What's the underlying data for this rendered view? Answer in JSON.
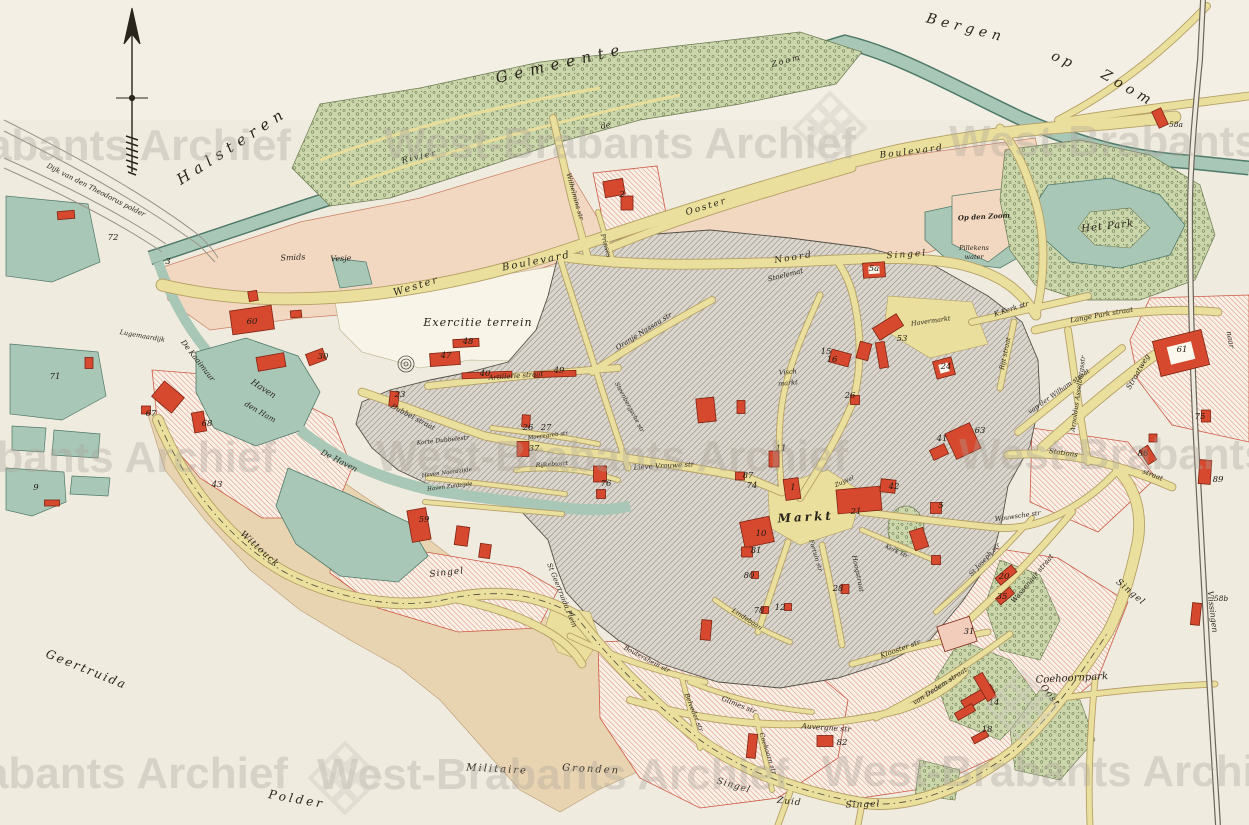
{
  "_format": "labels: t=text x,y=position r=rotation(deg) s=font-size ls=letter-spacing w=bold; numbers: building/parcel numbers printed on map; buildings: red building footprints x,y=center w,h=size r=rotation light=outlined-pale",
  "map_region": "Bergen op Zoom town plan",
  "labels": [
    {
      "t": "Gemeente",
      "x": 562,
      "y": 68,
      "r": -13,
      "s": 15,
      "ls": 7
    },
    {
      "t": "Halsteren",
      "x": 235,
      "y": 150,
      "r": -33,
      "s": 15,
      "ls": 6
    },
    {
      "t": "Bergen",
      "x": 965,
      "y": 32,
      "r": 14,
      "s": 14,
      "ls": 5
    },
    {
      "t": "op",
      "x": 1062,
      "y": 64,
      "r": 24,
      "s": 14,
      "ls": 4
    },
    {
      "t": "Zoom",
      "x": 1126,
      "y": 92,
      "r": 30,
      "s": 14,
      "ls": 5
    },
    {
      "t": "Geertruida",
      "x": 85,
      "y": 673,
      "r": 22,
      "s": 12,
      "ls": 2
    },
    {
      "t": "Polder",
      "x": 296,
      "y": 803,
      "r": 10,
      "s": 12,
      "ls": 3
    },
    {
      "t": "Militaire",
      "x": 497,
      "y": 772,
      "r": 3,
      "s": 10,
      "ls": 2
    },
    {
      "t": "Gronden",
      "x": 591,
      "y": 772,
      "r": 3,
      "s": 10,
      "ls": 2
    },
    {
      "t": "Exercitie terrein",
      "x": 478,
      "y": 326,
      "r": 0,
      "s": 11,
      "ls": 1
    },
    {
      "t": "Het Park",
      "x": 1108,
      "y": 229,
      "r": -6,
      "s": 10,
      "ls": 1
    },
    {
      "t": "Coehoornpark",
      "x": 1072,
      "y": 681,
      "r": -3,
      "s": 10,
      "ls": 0
    },
    {
      "t": "Markt",
      "x": 806,
      "y": 521,
      "r": -3,
      "s": 12,
      "ls": 3,
      "w": 1
    },
    {
      "t": "Wittouck",
      "x": 258,
      "y": 551,
      "r": 42,
      "s": 9,
      "ls": 1
    },
    {
      "t": "Smids",
      "x": 293,
      "y": 260,
      "r": -3,
      "s": 8
    },
    {
      "t": "Vesje",
      "x": 341,
      "y": 261,
      "r": -3,
      "s": 8
    },
    {
      "t": "Op den Zoom",
      "x": 984,
      "y": 219,
      "r": -3,
      "s": 7,
      "w": 1
    },
    {
      "t": "Pillekens",
      "x": 974,
      "y": 250,
      "r": 0,
      "s": 6.5
    },
    {
      "t": "water",
      "x": 974,
      "y": 259,
      "r": 0,
      "s": 6.5
    },
    {
      "t": "Dijk van den Theodorus polder",
      "x": 95,
      "y": 192,
      "r": 27,
      "s": 7
    },
    {
      "t": "Lugemaardijk",
      "x": 142,
      "y": 338,
      "r": 10,
      "s": 6.5
    },
    {
      "t": "De Kaaimuur",
      "x": 196,
      "y": 362,
      "r": 52,
      "s": 7.5
    },
    {
      "t": "Haven",
      "x": 262,
      "y": 391,
      "r": 33,
      "s": 8.5
    },
    {
      "t": "den Ham",
      "x": 259,
      "y": 414,
      "r": 30,
      "s": 7.5
    },
    {
      "t": "De Haven",
      "x": 338,
      "y": 463,
      "r": 27,
      "s": 8
    },
    {
      "t": "Haven Noordzijde",
      "x": 447,
      "y": 474,
      "r": -7,
      "s": 5.5
    },
    {
      "t": "Haven Zuidzijde",
      "x": 450,
      "y": 488,
      "r": -7,
      "s": 5.5
    },
    {
      "t": "Rivier",
      "x": 420,
      "y": 159,
      "r": -13,
      "s": 8,
      "ls": 2
    },
    {
      "t": "de",
      "x": 606,
      "y": 128,
      "r": -13,
      "s": 8
    },
    {
      "t": "Zoom",
      "x": 787,
      "y": 63,
      "r": -15,
      "s": 8,
      "ls": 2
    },
    {
      "t": "Wester",
      "x": 417,
      "y": 289,
      "r": -17,
      "s": 10,
      "ls": 2
    },
    {
      "t": "Boulevard",
      "x": 537,
      "y": 264,
      "r": -11,
      "s": 10,
      "ls": 2
    },
    {
      "t": "Boulevard",
      "x": 912,
      "y": 154,
      "r": -7,
      "s": 9,
      "ls": 2
    },
    {
      "t": "Ooster",
      "x": 707,
      "y": 209,
      "r": -17,
      "s": 9,
      "ls": 2
    },
    {
      "t": "Noord",
      "x": 794,
      "y": 260,
      "r": -9,
      "s": 9,
      "ls": 2
    },
    {
      "t": "Singel",
      "x": 907,
      "y": 257,
      "r": -4,
      "s": 9,
      "ls": 2
    },
    {
      "t": "Singel",
      "x": 447,
      "y": 575,
      "r": -6,
      "s": 9,
      "ls": 1
    },
    {
      "t": "Singel",
      "x": 733,
      "y": 788,
      "r": 16,
      "s": 9,
      "ls": 1
    },
    {
      "t": "Zuid",
      "x": 789,
      "y": 804,
      "r": 6,
      "s": 9,
      "ls": 1
    },
    {
      "t": "Singel",
      "x": 863,
      "y": 807,
      "r": -2,
      "s": 9,
      "ls": 1
    },
    {
      "t": "Oost",
      "x": 1048,
      "y": 697,
      "r": 52,
      "s": 9,
      "ls": 1
    },
    {
      "t": "Singel",
      "x": 1129,
      "y": 594,
      "r": 40,
      "s": 9,
      "ls": 1
    },
    {
      "t": "Stations",
      "x": 1063,
      "y": 455,
      "r": 8,
      "s": 7
    },
    {
      "t": "straat",
      "x": 1152,
      "y": 477,
      "r": 22,
      "s": 7
    },
    {
      "t": "Straatweg",
      "x": 1140,
      "y": 373,
      "r": -60,
      "s": 7.5
    },
    {
      "t": "Oranje Nassau str",
      "x": 645,
      "y": 333,
      "r": -32,
      "s": 7
    },
    {
      "t": "Artillerie straat",
      "x": 516,
      "y": 378,
      "r": -4,
      "s": 7
    },
    {
      "t": "Dubbel straat",
      "x": 412,
      "y": 419,
      "r": 28,
      "s": 7
    },
    {
      "t": "Korte Dubbelestr",
      "x": 443,
      "y": 442,
      "r": -6,
      "s": 6
    },
    {
      "t": "Moeregreb str",
      "x": 548,
      "y": 437,
      "r": -7,
      "s": 5.5
    },
    {
      "t": "Rijkebuurt",
      "x": 552,
      "y": 466,
      "r": -4,
      "s": 6
    },
    {
      "t": "Lieve Vrouwe str",
      "x": 664,
      "y": 468,
      "r": -3,
      "s": 7
    },
    {
      "t": "Stoelemat",
      "x": 786,
      "y": 277,
      "r": -14,
      "s": 7
    },
    {
      "t": "Visch",
      "x": 788,
      "y": 374,
      "r": -5,
      "s": 6.5
    },
    {
      "t": "markt",
      "x": 788,
      "y": 385,
      "r": -5,
      "s": 6.5
    },
    {
      "t": "Zuyvel",
      "x": 845,
      "y": 483,
      "r": -24,
      "s": 6
    },
    {
      "t": "Hoogstraat",
      "x": 856,
      "y": 574,
      "r": 78,
      "s": 6.5
    },
    {
      "t": "Fortuin str",
      "x": 814,
      "y": 556,
      "r": 73,
      "s": 6
    },
    {
      "t": "Kerk str",
      "x": 896,
      "y": 553,
      "r": 25,
      "s": 6
    },
    {
      "t": "Wouwsche str",
      "x": 1018,
      "y": 518,
      "r": -8,
      "s": 6.5
    },
    {
      "t": "Havermarkt",
      "x": 931,
      "y": 323,
      "r": -8,
      "s": 6.5
    },
    {
      "t": "K.Kerk str",
      "x": 1012,
      "y": 311,
      "r": -18,
      "s": 7
    },
    {
      "t": "Lange Park straat",
      "x": 1102,
      "y": 317,
      "r": -10,
      "s": 7
    },
    {
      "t": "Rijt straat",
      "x": 1007,
      "y": 354,
      "r": -78,
      "s": 6.5
    },
    {
      "t": "van der Wilham straat",
      "x": 1060,
      "y": 393,
      "r": -35,
      "s": 6.5
    },
    {
      "t": "Arnoldus Asselbergsstr",
      "x": 1080,
      "y": 394,
      "r": -82,
      "s": 6.5
    },
    {
      "t": "Wassenaar straat",
      "x": 1034,
      "y": 580,
      "r": -50,
      "s": 7
    },
    {
      "t": "St Joseph str",
      "x": 986,
      "y": 561,
      "r": -47,
      "s": 6.5
    },
    {
      "t": "Klooster str",
      "x": 901,
      "y": 651,
      "r": -20,
      "s": 7
    },
    {
      "t": "van Dedem straat",
      "x": 941,
      "y": 688,
      "r": -33,
      "s": 7
    },
    {
      "t": "Auvergne str",
      "x": 826,
      "y": 730,
      "r": 4,
      "s": 7.5
    },
    {
      "t": "Glimes str",
      "x": 738,
      "y": 707,
      "r": 22,
      "s": 7
    },
    {
      "t": "Belveder str",
      "x": 692,
      "y": 713,
      "r": 68,
      "s": 6.5
    },
    {
      "t": "Coehoorn str",
      "x": 766,
      "y": 754,
      "r": 72,
      "s": 6.5
    },
    {
      "t": "Boutershem str",
      "x": 646,
      "y": 661,
      "r": 28,
      "s": 6.5
    },
    {
      "t": "Lindebaan",
      "x": 746,
      "y": 621,
      "r": 33,
      "s": 6.5
    },
    {
      "t": "Steenbergsche str",
      "x": 628,
      "y": 408,
      "r": 62,
      "s": 6
    },
    {
      "t": "St Geertruida Plein",
      "x": 560,
      "y": 596,
      "r": 68,
      "s": 7
    },
    {
      "t": "Wilhelmina str",
      "x": 573,
      "y": 197,
      "r": 74,
      "s": 6.5
    },
    {
      "t": "Prinses",
      "x": 604,
      "y": 246,
      "r": 74,
      "s": 6.5
    },
    {
      "t": "naar",
      "x": 1228,
      "y": 340,
      "r": 80,
      "s": 7.5
    },
    {
      "t": "Vlissingen",
      "x": 1210,
      "y": 612,
      "r": 83,
      "s": 8
    }
  ],
  "numbers": [
    {
      "n": "3",
      "x": 168,
      "y": 264
    },
    {
      "n": "72",
      "x": 113,
      "y": 240
    },
    {
      "n": "71",
      "x": 55,
      "y": 379
    },
    {
      "n": "9",
      "x": 36,
      "y": 490
    },
    {
      "n": "43",
      "x": 217,
      "y": 487
    },
    {
      "n": "67",
      "x": 151,
      "y": 416
    },
    {
      "n": "68",
      "x": 207,
      "y": 426
    },
    {
      "n": "60",
      "x": 252,
      "y": 324
    },
    {
      "n": "30",
      "x": 323,
      "y": 359
    },
    {
      "n": "23",
      "x": 400,
      "y": 397
    },
    {
      "n": "59",
      "x": 424,
      "y": 522
    },
    {
      "n": "47",
      "x": 446,
      "y": 358
    },
    {
      "n": "48",
      "x": 468,
      "y": 344
    },
    {
      "n": "40",
      "x": 485,
      "y": 376
    },
    {
      "n": "49",
      "x": 559,
      "y": 373
    },
    {
      "n": "2",
      "x": 622,
      "y": 197
    },
    {
      "n": "26",
      "x": 528,
      "y": 430
    },
    {
      "n": "27",
      "x": 546,
      "y": 430
    },
    {
      "n": "37",
      "x": 534,
      "y": 451
    },
    {
      "n": "76",
      "x": 606,
      "y": 486
    },
    {
      "n": "15",
      "x": 826,
      "y": 354
    },
    {
      "n": "16",
      "x": 832,
      "y": 362
    },
    {
      "n": "53",
      "x": 902,
      "y": 341
    },
    {
      "n": "24",
      "x": 946,
      "y": 369
    },
    {
      "n": "5a",
      "x": 874,
      "y": 271
    },
    {
      "n": "63",
      "x": 980,
      "y": 433
    },
    {
      "n": "41",
      "x": 942,
      "y": 441
    },
    {
      "n": "11",
      "x": 781,
      "y": 451
    },
    {
      "n": "87",
      "x": 748,
      "y": 478
    },
    {
      "n": "74",
      "x": 752,
      "y": 488
    },
    {
      "n": "1",
      "x": 793,
      "y": 490
    },
    {
      "n": "26",
      "x": 850,
      "y": 398
    },
    {
      "n": "21",
      "x": 856,
      "y": 514
    },
    {
      "n": "42",
      "x": 894,
      "y": 489
    },
    {
      "n": "5",
      "x": 941,
      "y": 508
    },
    {
      "n": "10",
      "x": 761,
      "y": 536
    },
    {
      "n": "81",
      "x": 756,
      "y": 553
    },
    {
      "n": "80",
      "x": 749,
      "y": 578
    },
    {
      "n": "28",
      "x": 838,
      "y": 591
    },
    {
      "n": "78",
      "x": 759,
      "y": 613
    },
    {
      "n": "12",
      "x": 780,
      "y": 610
    },
    {
      "n": "82",
      "x": 842,
      "y": 745
    },
    {
      "n": "31",
      "x": 969,
      "y": 634
    },
    {
      "n": "20",
      "x": 1004,
      "y": 579
    },
    {
      "n": "35",
      "x": 1002,
      "y": 599
    },
    {
      "n": "14",
      "x": 994,
      "y": 705
    },
    {
      "n": "18",
      "x": 987,
      "y": 732
    },
    {
      "n": "61",
      "x": 1182,
      "y": 352
    },
    {
      "n": "75",
      "x": 1200,
      "y": 419
    },
    {
      "n": "86",
      "x": 1143,
      "y": 456
    },
    {
      "n": "89",
      "x": 1218,
      "y": 482
    },
    {
      "n": "58a",
      "x": 1176,
      "y": 127
    },
    {
      "n": "58b",
      "x": 1221,
      "y": 601
    }
  ],
  "buildings": [
    {
      "x": 614,
      "y": 188,
      "w": 20,
      "h": 16,
      "r": -10
    },
    {
      "x": 627,
      "y": 203,
      "w": 12,
      "h": 14,
      "r": 0
    },
    {
      "x": 1160,
      "y": 118,
      "w": 10,
      "h": 18,
      "r": -25
    },
    {
      "x": 252,
      "y": 320,
      "w": 42,
      "h": 24,
      "r": -8
    },
    {
      "x": 253,
      "y": 296,
      "w": 9,
      "h": 10,
      "r": -10
    },
    {
      "x": 296,
      "y": 314,
      "w": 11,
      "h": 7,
      "r": -5
    },
    {
      "x": 271,
      "y": 362,
      "w": 28,
      "h": 14,
      "r": -10
    },
    {
      "x": 316,
      "y": 357,
      "w": 18,
      "h": 12,
      "r": -20
    },
    {
      "x": 168,
      "y": 397,
      "w": 26,
      "h": 20,
      "r": 40
    },
    {
      "x": 146,
      "y": 410,
      "w": 9,
      "h": 8,
      "r": 0
    },
    {
      "x": 199,
      "y": 422,
      "w": 12,
      "h": 20,
      "r": -10
    },
    {
      "x": 66,
      "y": 215,
      "w": 17,
      "h": 8,
      "r": -5
    },
    {
      "x": 89,
      "y": 363,
      "w": 8,
      "h": 11,
      "r": 0
    },
    {
      "x": 52,
      "y": 503,
      "w": 15,
      "h": 6,
      "r": 0
    },
    {
      "x": 445,
      "y": 359,
      "w": 30,
      "h": 13,
      "r": -4
    },
    {
      "x": 466,
      "y": 343,
      "w": 26,
      "h": 8,
      "r": -3
    },
    {
      "x": 487,
      "y": 375,
      "w": 50,
      "h": 6,
      "r": -2
    },
    {
      "x": 555,
      "y": 374,
      "w": 42,
      "h": 6,
      "r": -2
    },
    {
      "x": 394,
      "y": 399,
      "w": 9,
      "h": 15,
      "r": 6
    },
    {
      "x": 419,
      "y": 525,
      "w": 19,
      "h": 32,
      "r": -10
    },
    {
      "x": 462,
      "y": 536,
      "w": 13,
      "h": 19,
      "r": 8
    },
    {
      "x": 485,
      "y": 551,
      "w": 11,
      "h": 14,
      "r": 8
    },
    {
      "x": 526,
      "y": 421,
      "w": 8,
      "h": 12,
      "r": 4
    },
    {
      "x": 523,
      "y": 449,
      "w": 12,
      "h": 15,
      "r": 0
    },
    {
      "x": 600,
      "y": 474,
      "w": 13,
      "h": 16,
      "r": 0
    },
    {
      "x": 601,
      "y": 494,
      "w": 9,
      "h": 9,
      "r": 0
    },
    {
      "x": 840,
      "y": 358,
      "w": 20,
      "h": 13,
      "r": 15
    },
    {
      "x": 864,
      "y": 351,
      "w": 12,
      "h": 17,
      "r": 15
    },
    {
      "x": 888,
      "y": 327,
      "w": 28,
      "h": 14,
      "r": -32
    },
    {
      "x": 882,
      "y": 355,
      "w": 9,
      "h": 26,
      "r": -10
    },
    {
      "x": 944,
      "y": 368,
      "w": 19,
      "h": 18,
      "r": -15,
      "box": 1
    },
    {
      "x": 874,
      "y": 270,
      "w": 22,
      "h": 15,
      "r": -4,
      "box": 1
    },
    {
      "x": 963,
      "y": 441,
      "w": 27,
      "h": 28,
      "r": -25
    },
    {
      "x": 939,
      "y": 452,
      "w": 16,
      "h": 11,
      "r": -25
    },
    {
      "x": 774,
      "y": 459,
      "w": 10,
      "h": 16,
      "r": 0
    },
    {
      "x": 740,
      "y": 476,
      "w": 9,
      "h": 8,
      "r": 0
    },
    {
      "x": 792,
      "y": 489,
      "w": 15,
      "h": 21,
      "r": -8
    },
    {
      "x": 855,
      "y": 400,
      "w": 9,
      "h": 9,
      "r": 0
    },
    {
      "x": 706,
      "y": 410,
      "w": 18,
      "h": 24,
      "r": -6
    },
    {
      "x": 741,
      "y": 407,
      "w": 8,
      "h": 13,
      "r": 0
    },
    {
      "x": 859,
      "y": 500,
      "w": 44,
      "h": 24,
      "r": -5
    },
    {
      "x": 888,
      "y": 486,
      "w": 15,
      "h": 13,
      "r": 6
    },
    {
      "x": 936,
      "y": 508,
      "w": 11,
      "h": 11,
      "r": 0
    },
    {
      "x": 757,
      "y": 532,
      "w": 30,
      "h": 26,
      "r": -12
    },
    {
      "x": 747,
      "y": 552,
      "w": 11,
      "h": 10,
      "r": 0
    },
    {
      "x": 755,
      "y": 575,
      "w": 7,
      "h": 7,
      "r": 0
    },
    {
      "x": 845,
      "y": 589,
      "w": 8,
      "h": 9,
      "r": 0
    },
    {
      "x": 765,
      "y": 610,
      "w": 7,
      "h": 7,
      "r": 0
    },
    {
      "x": 788,
      "y": 607,
      "w": 7,
      "h": 7,
      "r": 0
    },
    {
      "x": 706,
      "y": 630,
      "w": 10,
      "h": 20,
      "r": 5
    },
    {
      "x": 919,
      "y": 539,
      "w": 14,
      "h": 20,
      "r": -18
    },
    {
      "x": 936,
      "y": 560,
      "w": 9,
      "h": 9,
      "r": 0
    },
    {
      "x": 825,
      "y": 741,
      "w": 16,
      "h": 11,
      "r": 0
    },
    {
      "x": 752,
      "y": 746,
      "w": 9,
      "h": 24,
      "r": 6
    },
    {
      "x": 957,
      "y": 634,
      "w": 34,
      "h": 26,
      "r": -18,
      "light": 1
    },
    {
      "x": 1006,
      "y": 575,
      "w": 21,
      "h": 9,
      "r": -40
    },
    {
      "x": 1005,
      "y": 596,
      "w": 18,
      "h": 8,
      "r": -40
    },
    {
      "x": 978,
      "y": 697,
      "w": 34,
      "h": 10,
      "r": -30
    },
    {
      "x": 985,
      "y": 687,
      "w": 10,
      "h": 28,
      "r": -30
    },
    {
      "x": 965,
      "y": 712,
      "w": 20,
      "h": 8,
      "r": -30
    },
    {
      "x": 980,
      "y": 737,
      "w": 16,
      "h": 7,
      "r": -28
    },
    {
      "x": 1181,
      "y": 353,
      "w": 50,
      "h": 36,
      "r": -14,
      "box": 1
    },
    {
      "x": 1206,
      "y": 416,
      "w": 9,
      "h": 12,
      "r": 0
    },
    {
      "x": 1148,
      "y": 455,
      "w": 10,
      "h": 17,
      "r": -32
    },
    {
      "x": 1153,
      "y": 438,
      "w": 8,
      "h": 8,
      "r": 0
    },
    {
      "x": 1205,
      "y": 472,
      "w": 12,
      "h": 24,
      "r": 4
    },
    {
      "x": 1196,
      "y": 614,
      "w": 9,
      "h": 22,
      "r": 6
    }
  ],
  "watermark": {
    "text": "West-Brabants Archief",
    "positions": [
      {
        "x": 55,
        "y": 160
      },
      {
        "x": 620,
        "y": 158
      },
      {
        "x": 1185,
        "y": 156
      },
      {
        "x": 40,
        "y": 472
      },
      {
        "x": 612,
        "y": 471
      },
      {
        "x": 1195,
        "y": 469
      },
      {
        "x": 52,
        "y": 788
      },
      {
        "x": 553,
        "y": 789
      },
      {
        "x": 1058,
        "y": 786
      }
    ],
    "logos": [
      {
        "x": 830,
        "y": 128
      },
      {
        "x": 345,
        "y": 778
      },
      {
        "x": 1022,
        "y": 706
      }
    ]
  },
  "colors": {
    "paper": "#f0ebdf",
    "field_salmon": "#f2d8c1",
    "field_tan": "#e9d4b2",
    "water": "#a9c7b7",
    "water_edge": "#4f7a6a",
    "street": "#ebdf9d",
    "park": "#ccd6ab",
    "building_red": "#d6492f",
    "hatch_gray": "#8d887d",
    "hatch_pink": "#dd8d7c"
  }
}
